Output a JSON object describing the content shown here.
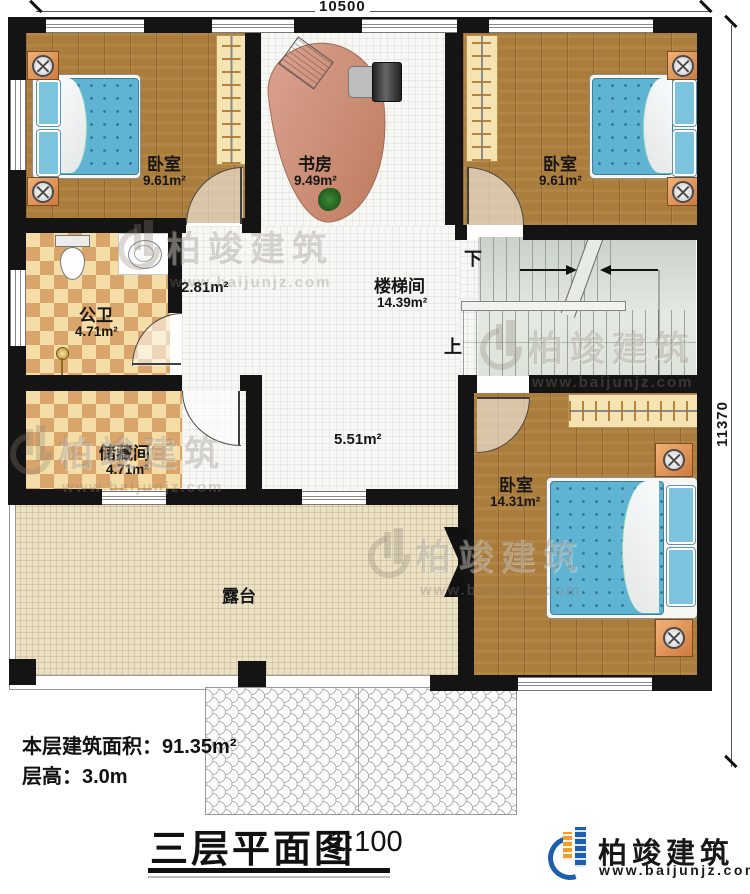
{
  "dimensions": {
    "width": "10500",
    "height": "11370"
  },
  "rooms": {
    "bedroom_tl": {
      "name": "卧室",
      "area": "9.61m²"
    },
    "study": {
      "name": "书房",
      "area": "9.49m²"
    },
    "bedroom_tr": {
      "name": "卧室",
      "area": "9.61m²"
    },
    "bathroom": {
      "name": "公卫",
      "area": "4.71m²"
    },
    "storage": {
      "name": "储藏间",
      "area": "4.71m²"
    },
    "stairwell": {
      "name": "楼梯间",
      "area": "14.39m²"
    },
    "bedroom_se": {
      "name": "卧室",
      "area": "14.31m²"
    },
    "terrace": {
      "name": "露台"
    },
    "hall_upper_area": "2.81m²",
    "hall_lower_area": "5.51m²"
  },
  "stairs": {
    "down": "下",
    "up": "上"
  },
  "footer": {
    "floor_area_label": "本层建筑面积：",
    "floor_area_value": "91.35m²",
    "floor_height_label": "层高：",
    "floor_height_value": "3.0m",
    "title": "三层平面图",
    "scale": "1:100"
  },
  "brand": {
    "name": "柏竣建筑",
    "website": "www.baijunjz.com"
  },
  "watermark": {
    "name": "柏竣建筑",
    "website": "www.baijunjz.com"
  },
  "colors": {
    "wall": "#141414",
    "bed": "#5fb3d3",
    "logo_blue": "#1d5fae",
    "logo_orange": "#f09f2d"
  }
}
